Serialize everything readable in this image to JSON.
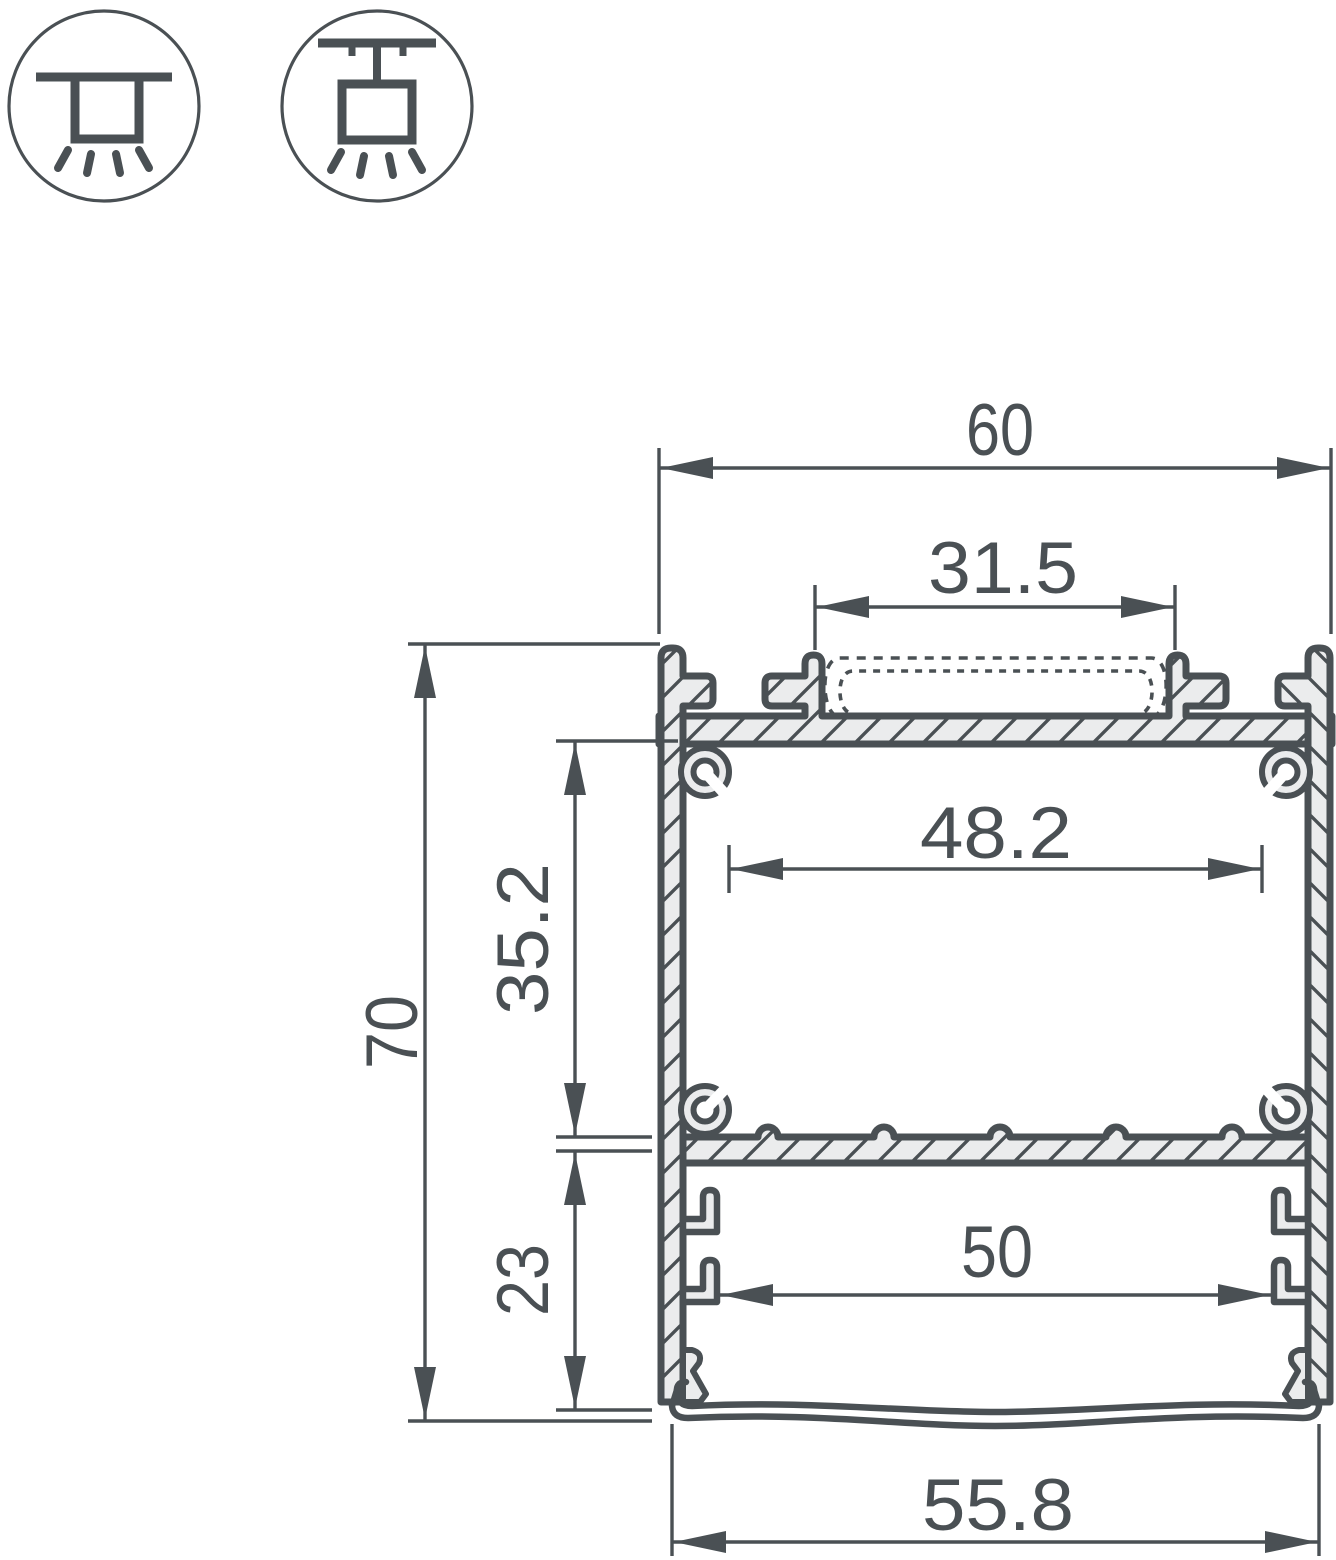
{
  "title": "LED aluminium profile cross-section drawing",
  "icons": {
    "surface_mount": "surface-ceiling-mount",
    "pendant_mount": "suspended-pendant-mount"
  },
  "dimensions": {
    "overall_width": "60",
    "slot_width": "31.5",
    "inner_width": "48.2",
    "upper_chamber_height": "35.2",
    "overall_height": "70",
    "lower_chamber_height": "23",
    "lower_inner_width": "50",
    "diffuser_width": "55.8"
  },
  "colors": {
    "line": "#4a5054",
    "aluminium_fill": "#ebeced",
    "background": "#ffffff"
  }
}
